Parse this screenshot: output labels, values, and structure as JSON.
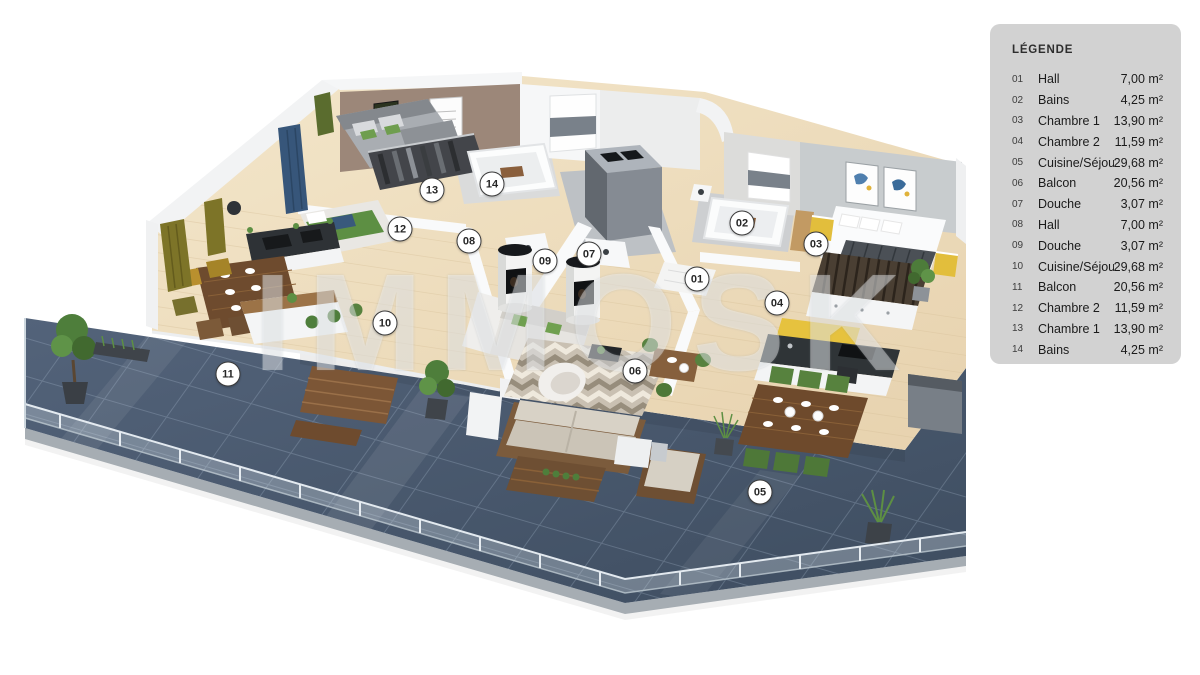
{
  "legend": {
    "title": "LÉGENDE",
    "items": [
      {
        "id": "01",
        "name": "Hall",
        "area": "7,00 m²"
      },
      {
        "id": "02",
        "name": "Bains",
        "area": "4,25 m²"
      },
      {
        "id": "03",
        "name": "Chambre 1",
        "area": "13,90 m²"
      },
      {
        "id": "04",
        "name": "Chambre 2",
        "area": "11,59 m²"
      },
      {
        "id": "05",
        "name": "Cuisine/Séjour",
        "area": "29,68 m²"
      },
      {
        "id": "06",
        "name": "Balcon",
        "area": "20,56 m²"
      },
      {
        "id": "07",
        "name": "Douche",
        "area": "3,07 m²"
      },
      {
        "id": "08",
        "name": "Hall",
        "area": "7,00 m²"
      },
      {
        "id": "09",
        "name": "Douche",
        "area": "3,07 m²"
      },
      {
        "id": "10",
        "name": "Cuisine/Séjour",
        "area": "29,68 m²"
      },
      {
        "id": "11",
        "name": "Balcon",
        "area": "20,56 m²"
      },
      {
        "id": "12",
        "name": "Chambre 2",
        "area": "11,59 m²"
      },
      {
        "id": "13",
        "name": "Chambre 1",
        "area": "13,90 m²"
      },
      {
        "id": "14",
        "name": "Bains",
        "area": "4,25 m²"
      }
    ]
  },
  "markers": [
    {
      "label": "01",
      "x": 697,
      "y": 279
    },
    {
      "label": "02",
      "x": 742,
      "y": 223
    },
    {
      "label": "03",
      "x": 816,
      "y": 244
    },
    {
      "label": "04",
      "x": 777,
      "y": 303
    },
    {
      "label": "05",
      "x": 760,
      "y": 492
    },
    {
      "label": "06",
      "x": 635,
      "y": 371
    },
    {
      "label": "07",
      "x": 589,
      "y": 254
    },
    {
      "label": "08",
      "x": 469,
      "y": 241
    },
    {
      "label": "09",
      "x": 545,
      "y": 261
    },
    {
      "label": "10",
      "x": 385,
      "y": 323
    },
    {
      "label": "11",
      "x": 228,
      "y": 374
    },
    {
      "label": "12",
      "x": 400,
      "y": 229
    },
    {
      "label": "13",
      "x": 432,
      "y": 190
    },
    {
      "label": "14",
      "x": 492,
      "y": 184
    }
  ],
  "watermark": {
    "text": "IMMOSK"
  },
  "colors": {
    "terrace_tile": "#4a5a6d",
    "wood_floor": "#eedcbc",
    "legend_bg": "#d2d2d2",
    "accent_green": "#57823e",
    "accent_yellow": "#e2be3c"
  }
}
